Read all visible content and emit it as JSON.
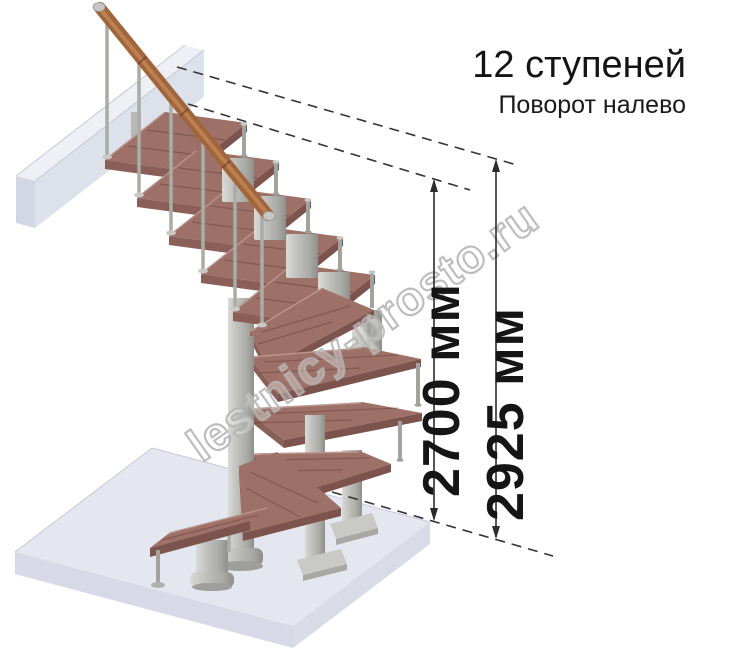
{
  "header": {
    "steps_label": "12 ступеней",
    "turn_label": "Поворот налево"
  },
  "dimensions": {
    "stair_height_label": "2700 мм",
    "total_height_label": "2925 мм"
  },
  "watermark_text": "lestnicy-prosto.ru",
  "colors": {
    "wood-top": "#9d7168",
    "wood-front": "#7c544d",
    "wood-side": "#8a5f58",
    "handrail": "#a0653a",
    "metal": "#b7b7b3",
    "floor-top": "#e4e6f0",
    "floor-front": "#d9dce7",
    "dimension-ink": "#2b2b2b",
    "watermark-gray": "#b3b3b3",
    "text-ink": "#141414"
  }
}
